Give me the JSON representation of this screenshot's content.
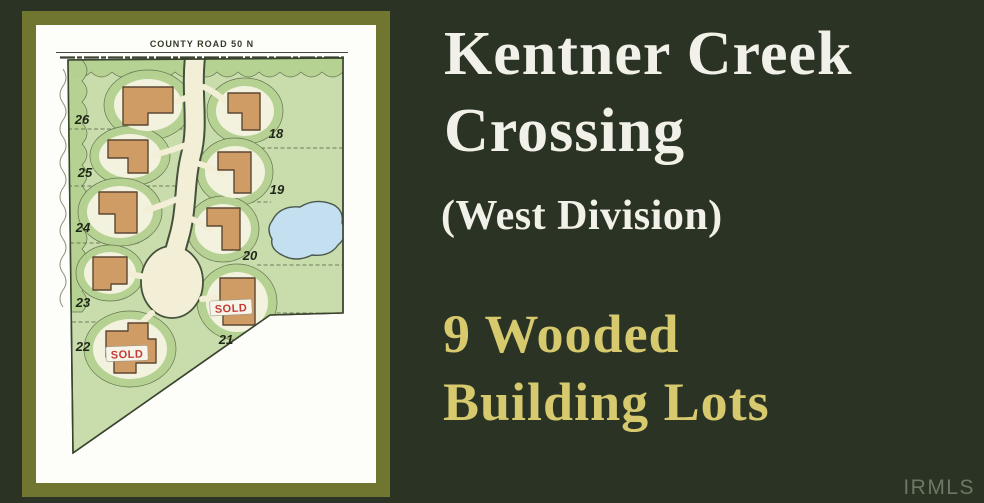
{
  "colors": {
    "background": "#2b3424",
    "frame_olive": "#70762f",
    "title_text": "#f2f1e9",
    "tagline_gold": "#d7c96e",
    "sold_red": "#c43b35",
    "map_green": "#c9dcab",
    "pond_blue": "#c3dff0",
    "house_tan": "#d09c66"
  },
  "banner": {
    "title_line1": "Kentner Creek",
    "title_line2": "Crossing",
    "subtitle": "(West Division)",
    "tagline_line1": "9 Wooded",
    "tagline_line2": "Building Lots"
  },
  "plat": {
    "road_label": "COUNTY ROAD 50 N",
    "sold_label": "SOLD",
    "lots": [
      {
        "number": "18",
        "sold": false
      },
      {
        "number": "19",
        "sold": false
      },
      {
        "number": "20",
        "sold": false
      },
      {
        "number": "21",
        "sold": true
      },
      {
        "number": "22",
        "sold": true
      },
      {
        "number": "23",
        "sold": false
      },
      {
        "number": "24",
        "sold": false
      },
      {
        "number": "25",
        "sold": false
      },
      {
        "number": "26",
        "sold": false
      }
    ]
  },
  "watermark": "IRMLS"
}
